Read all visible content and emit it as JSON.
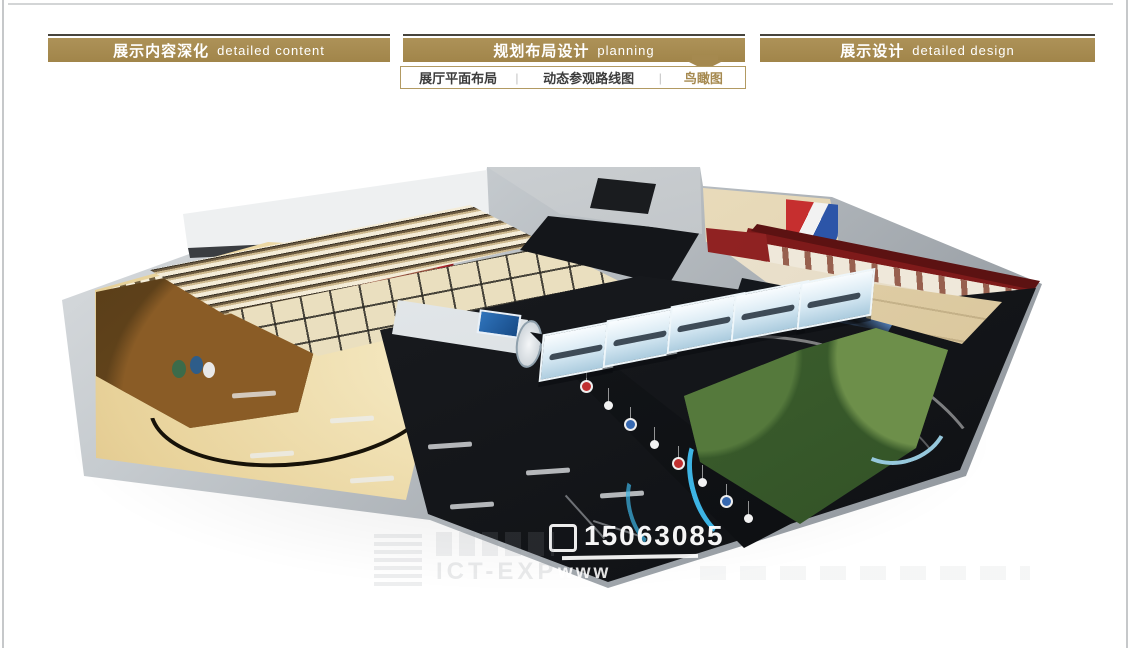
{
  "header": {
    "tabs": [
      {
        "zh": "展示内容深化",
        "en": "detailed content"
      },
      {
        "zh": "规划布局设计",
        "en": "planning"
      },
      {
        "zh": "展示设计",
        "en": "detailed design"
      }
    ],
    "subnav": {
      "items": [
        {
          "label": "展厅平面布局"
        },
        {
          "label": "动态参观路线图"
        },
        {
          "label": "鸟瞰图"
        }
      ],
      "active_index": 2,
      "separator": "|"
    }
  },
  "watermark": {
    "phone": "15063085",
    "url_prefix": "www",
    "faint_text": "ICT-EXP"
  },
  "colors": {
    "gold": "#a5894f",
    "tab_text": "#ffffff",
    "subnav_active": "#a5894f",
    "maroon_trim": "#5c1212"
  }
}
